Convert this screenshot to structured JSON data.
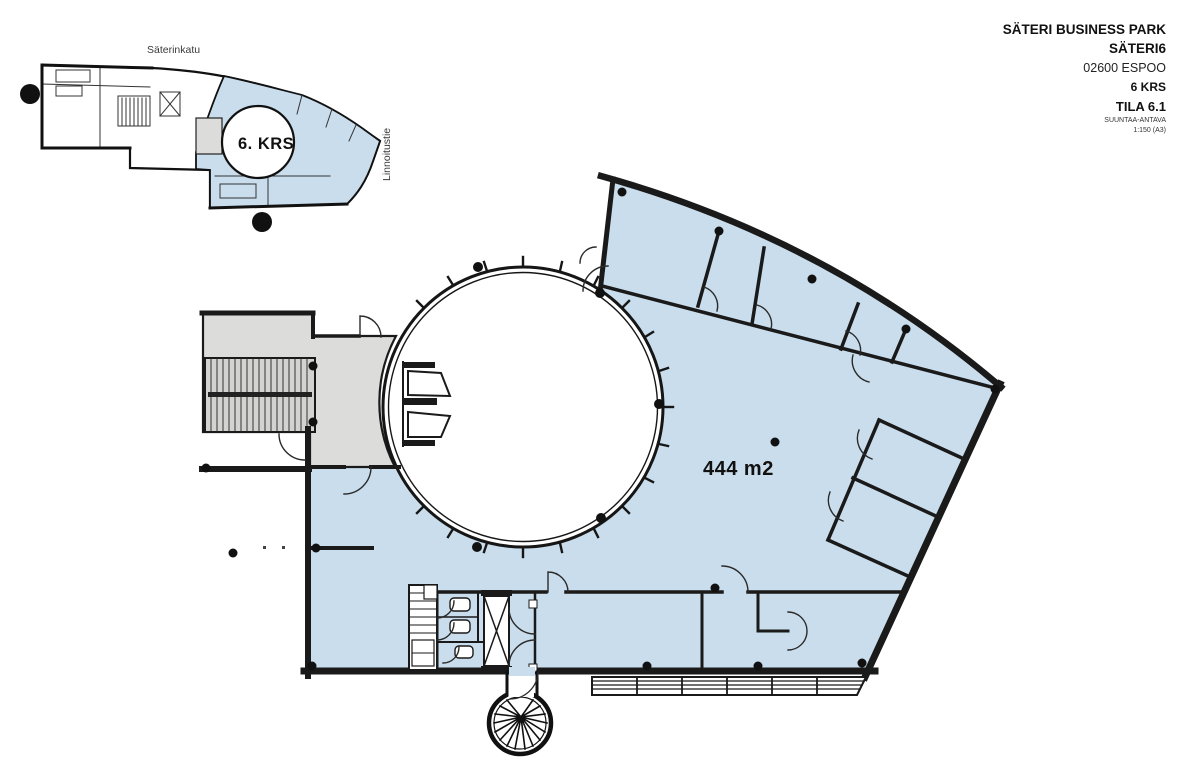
{
  "title_block": {
    "project": "SÄTERI BUSINESS PARK",
    "building": "SÄTERI6",
    "address": "02600 ESPOO",
    "floor": "6 KRS",
    "space": "TILA 6.1",
    "disclaimer": "SUUNTAA-ANTAVA",
    "scale": "1:150 (A3)"
  },
  "mini_map": {
    "street_top": "Säterinkatu",
    "street_right": "Linnoitustie",
    "floor_label": "6. KRS"
  },
  "main_plan": {
    "area_label": "444 m2"
  },
  "colors": {
    "highlight": "#c9ddec",
    "core_gray": "#dcdcda",
    "stair_gray": "#d3d3d1",
    "wall": "#1a1a1a"
  }
}
